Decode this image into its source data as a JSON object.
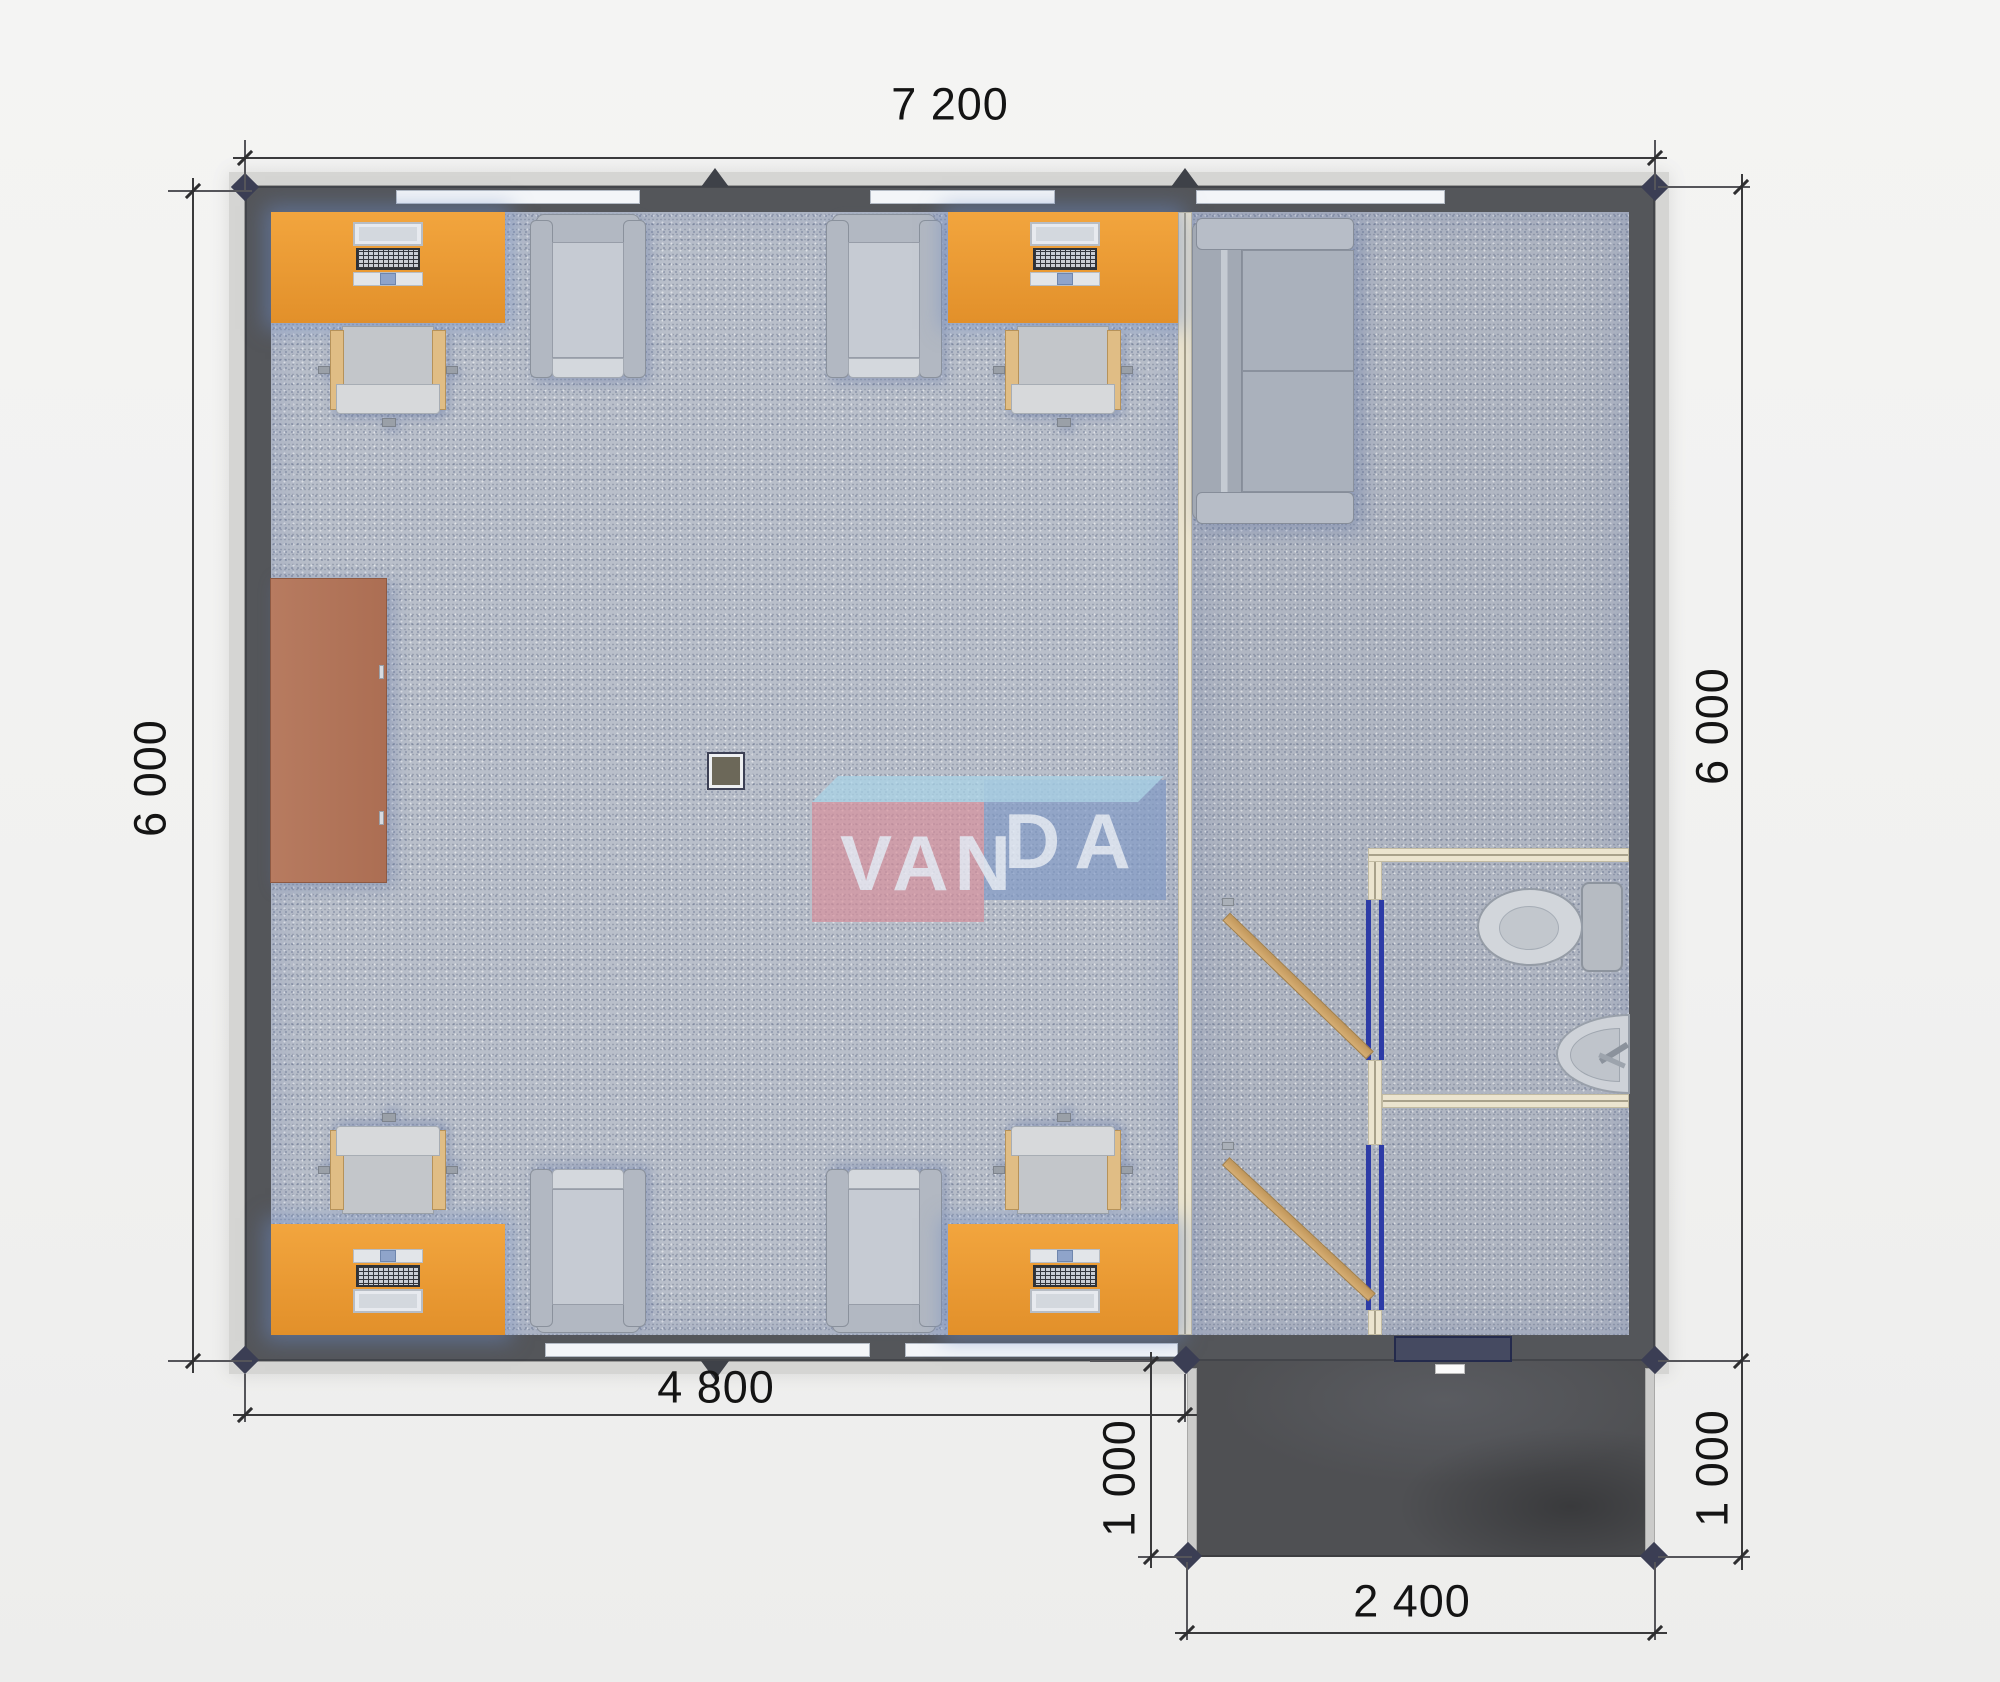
{
  "plan": {
    "type": "floor-plan-render",
    "watermark": {
      "part1": "VAN",
      "part2": "DA",
      "pink": "#d88e9b",
      "blue": "#8099c6",
      "light_blue": "#a9d3e8",
      "letters": "#e8eef6"
    },
    "dims": {
      "top": "7 200",
      "left": "6 000",
      "right": "6 000",
      "bottom_left": "4 800",
      "porch_bottom": "2 400",
      "porch_side_left": "1 000",
      "porch_side_right": "1 000"
    },
    "colors": {
      "background": "#f1f1f0",
      "exterior_wall": "#54565a",
      "roof_edge": "#d5d5d3",
      "floor_office": "#b9bfca",
      "floor_right": "#b0b6c2",
      "desk_orange": "#e89a30",
      "cabinet_brown": "#b3775c",
      "partition_cream": "#ebe4cf",
      "door_wood": "#cda467",
      "door_frame_blue": "#2d3ba6",
      "porch_dark": "#4f5053",
      "furniture_gray": "#b2b8c2"
    },
    "furniture": [
      {
        "name": "office-desk",
        "count": 4
      },
      {
        "name": "laptop",
        "count": 4
      },
      {
        "name": "desk-chair",
        "count": 4
      },
      {
        "name": "armchair",
        "count": 4
      },
      {
        "name": "wardrobe-cabinet",
        "count": 1
      },
      {
        "name": "sofa",
        "count": 1
      },
      {
        "name": "toilet",
        "count": 1
      },
      {
        "name": "sink",
        "count": 1
      },
      {
        "name": "interior-door",
        "count": 2
      },
      {
        "name": "entrance-door",
        "count": 1
      },
      {
        "name": "column",
        "count": 1
      },
      {
        "name": "porch",
        "count": 1
      }
    ]
  }
}
